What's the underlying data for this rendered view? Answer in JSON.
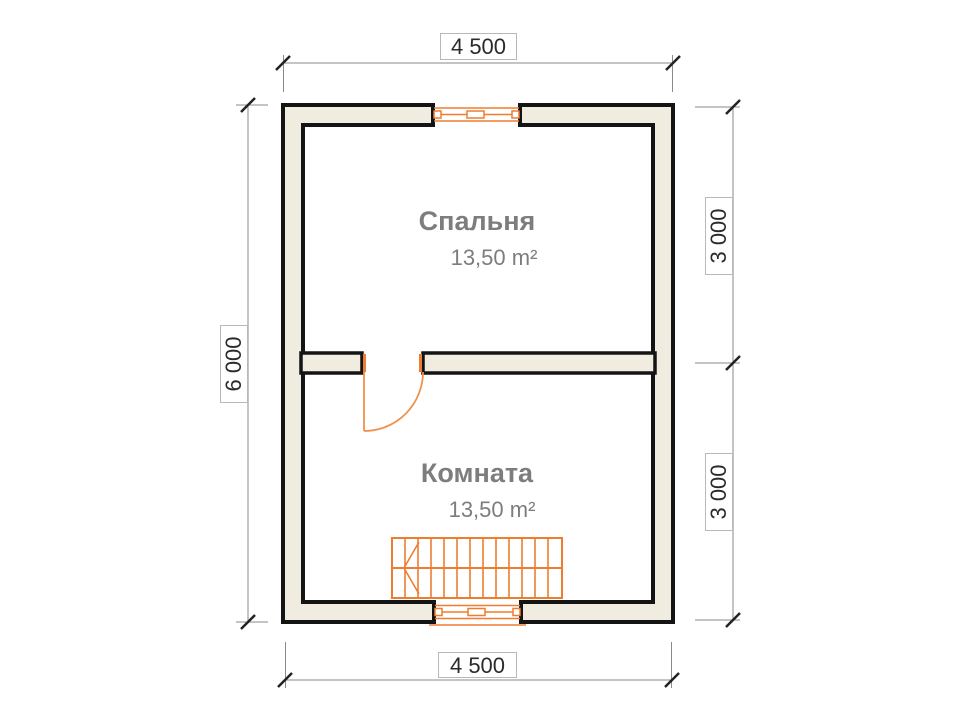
{
  "plan": {
    "dimensions": {
      "top": "4 500",
      "bottom": "4 500",
      "left": "6 000",
      "right_upper": "3 000",
      "right_lower": "3 000"
    },
    "rooms": {
      "bedroom": {
        "name": "Спальня",
        "area": "13,50 m²"
      },
      "living": {
        "name": "Комната",
        "area": "13,50 m²"
      }
    },
    "colors": {
      "wall_outline": "#141414",
      "wall_fill": "#F0ECDF",
      "joinery_orange": "#ED7D31",
      "door_orange": "#F0914A",
      "dimension_line": "#8A8A8A",
      "dimension_text": "#2B2B2B",
      "room_text": "#7D7D7D"
    }
  }
}
